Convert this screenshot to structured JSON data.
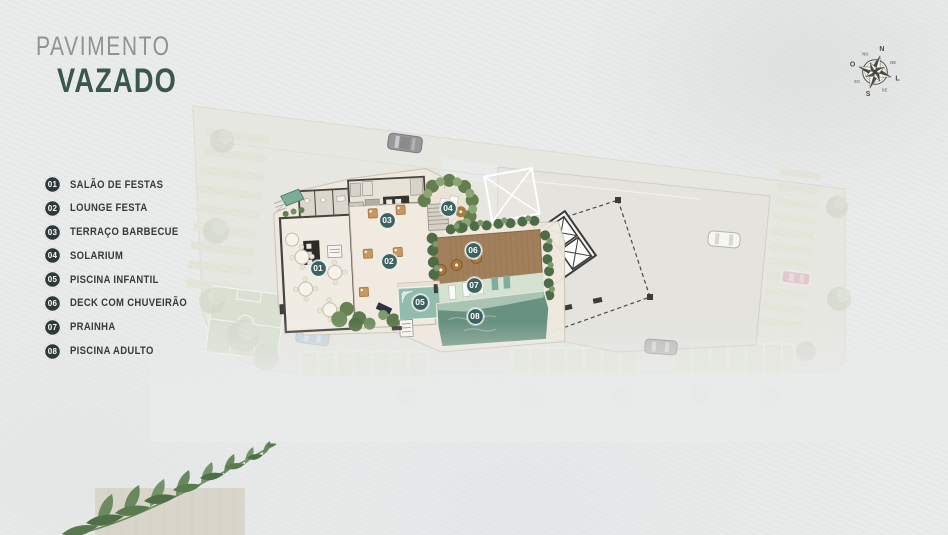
{
  "title": {
    "line1": "PAVIMENTO",
    "line2": "VAZADO"
  },
  "legend": {
    "items": [
      {
        "num": "01",
        "label": "SALÃO DE FESTAS"
      },
      {
        "num": "02",
        "label": "LOUNGE FESTA"
      },
      {
        "num": "03",
        "label": "TERRAÇO BARBECUE"
      },
      {
        "num": "04",
        "label": "SOLARIUM"
      },
      {
        "num": "05",
        "label": "PISCINA INFANTIL"
      },
      {
        "num": "06",
        "label": "DECK COM CHUVEIRÃO"
      },
      {
        "num": "07",
        "label": "PRAINHA"
      },
      {
        "num": "08",
        "label": "PISCINA ADULTO"
      }
    ]
  },
  "compass": {
    "n": "N",
    "o": "O",
    "l": "L",
    "s": "S",
    "ne": "NE",
    "se": "SE",
    "so": "SO",
    "no": "NO"
  },
  "colors": {
    "accent": "#3A564F",
    "legend_badge": "#2E3939",
    "plan_marker": "#3D6361",
    "adult_pool": "#68917F",
    "kids_pool": "#92BDAE",
    "wood_deck": "#A17F5B",
    "site_slab": "#E7E5DA",
    "floor_cream": "#F0EBE2"
  }
}
